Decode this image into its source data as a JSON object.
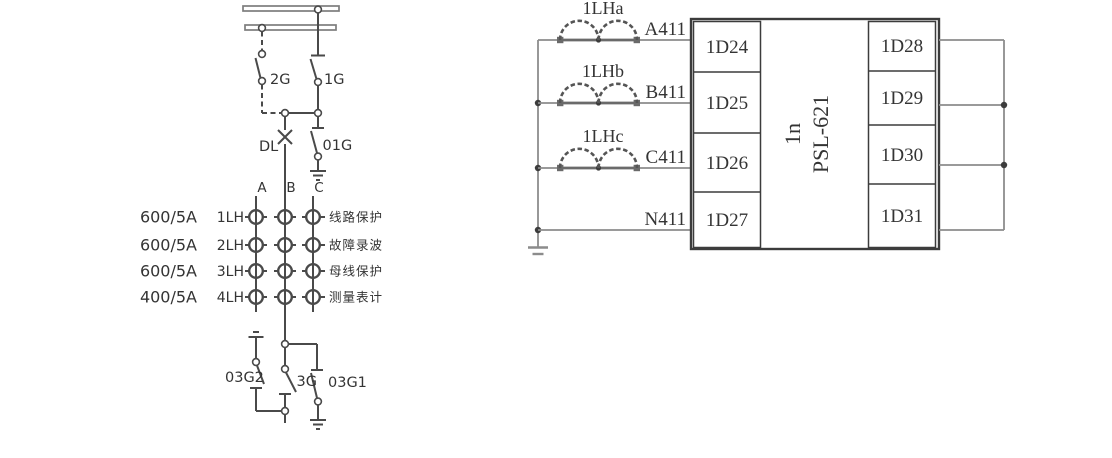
{
  "colors": {
    "line_dark": "#4a4a4a",
    "line_gray": "#8c8c8c",
    "busbar_gray": "#7d7d7d",
    "box_border": "#3c3c3c",
    "text": "#343434",
    "background": "#ffffff"
  },
  "left_panel": {
    "disconnector_2g": "2G",
    "disconnector_1g": "1G",
    "earth_switch_01g": "01G",
    "breaker_dl": "DL",
    "phase_a": "A",
    "phase_b": "B",
    "phase_c": "C",
    "ct_rows": [
      {
        "ratio": "600/5A",
        "name": "1LH",
        "purpose": "线路保护"
      },
      {
        "ratio": "600/5A",
        "name": "2LH",
        "purpose": "故障录波"
      },
      {
        "ratio": "600/5A",
        "name": "3LH",
        "purpose": "母线保护"
      },
      {
        "ratio": "400/5A",
        "name": "4LH",
        "purpose": "测量表计"
      }
    ],
    "earth_switch_03g2": "03G2",
    "disconnector_3g": "3G",
    "earth_switch_03g1": "03G1"
  },
  "right_panel": {
    "ct_a": "1LHa",
    "ct_b": "1LHb",
    "ct_c": "1LHc",
    "wire_a": "A411",
    "wire_b": "B411",
    "wire_c": "C411",
    "wire_n": "N411",
    "input_terminals": [
      "1D24",
      "1D25",
      "1D26",
      "1D27"
    ],
    "device_id": "1n",
    "device_model": "PSL-621",
    "output_terminals": [
      "1D28",
      "1D29",
      "1D30",
      "1D31"
    ]
  }
}
